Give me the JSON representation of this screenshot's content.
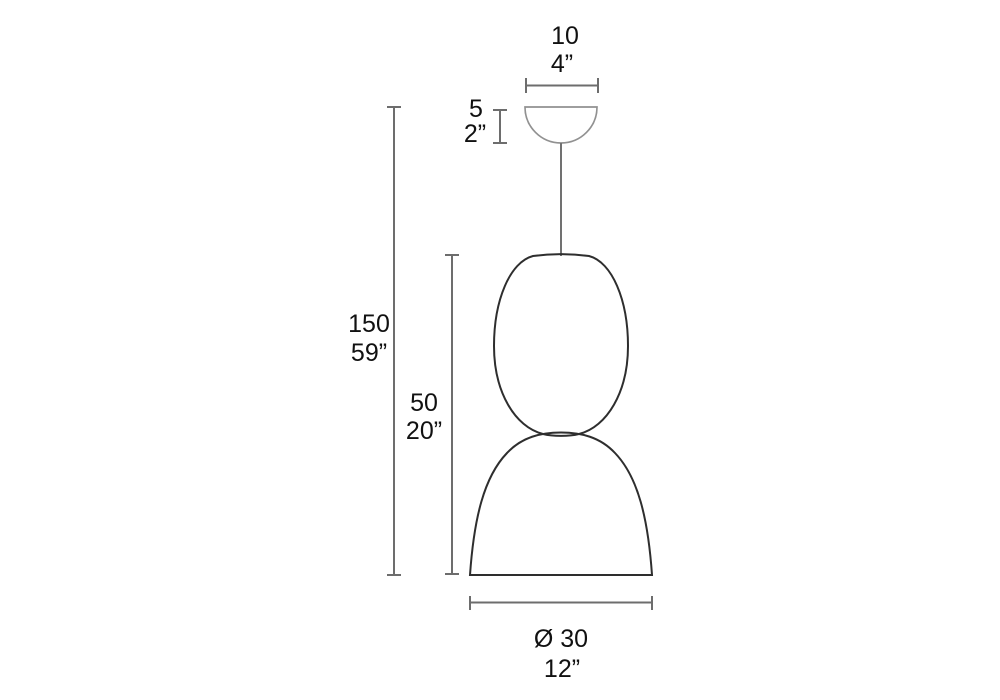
{
  "diagram": {
    "title": "Pendant lamp dimension drawing",
    "dimensions": {
      "canopy_width": {
        "metric": "10",
        "imperial": "4”"
      },
      "canopy_height": {
        "metric": "5",
        "imperial": "2”"
      },
      "total_height": {
        "metric": "150",
        "imperial": "59”"
      },
      "shade_height": {
        "metric": "50",
        "imperial": "20”"
      },
      "diameter": {
        "metric": "Ø 30",
        "imperial": "12”"
      }
    },
    "colors": {
      "background": "#ffffff",
      "shade_outline": "#2e2e2e",
      "canopy_outline": "#919191",
      "dimension_lines": "#6d6d6d",
      "text": "#111111"
    }
  }
}
